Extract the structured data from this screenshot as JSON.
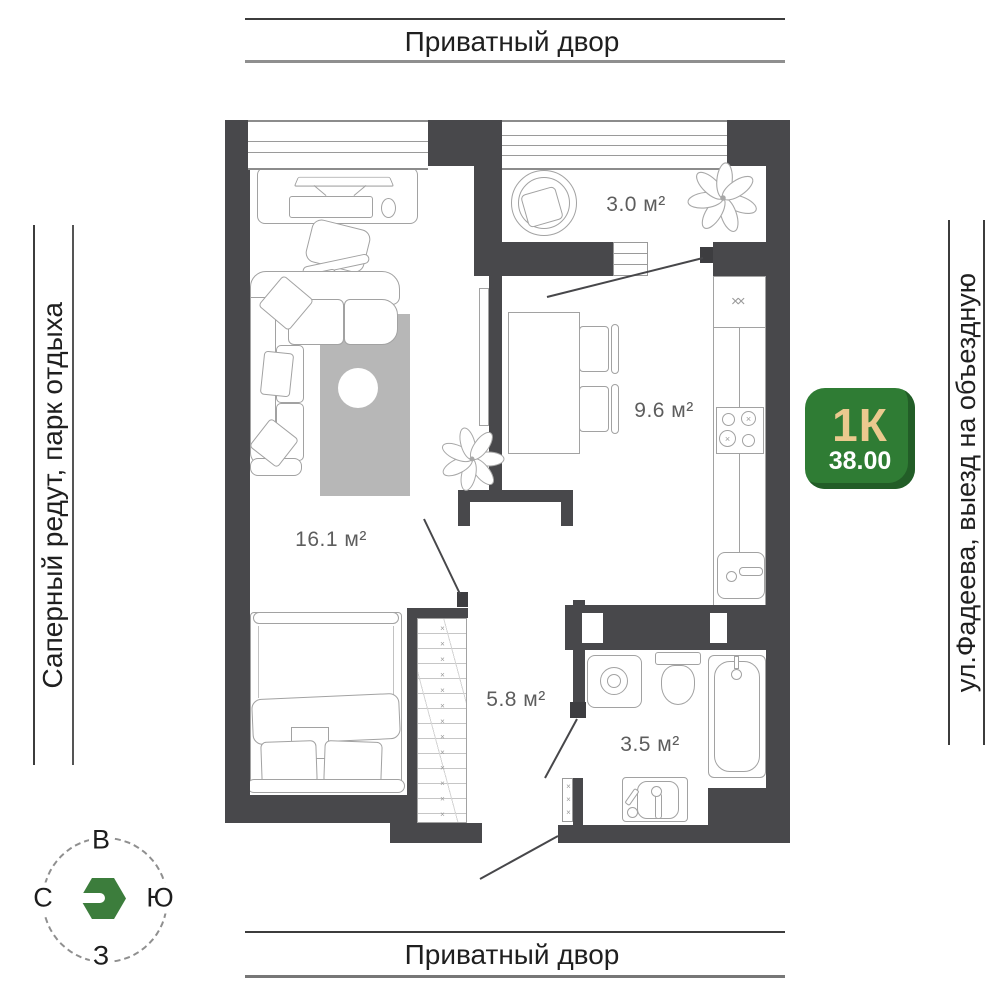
{
  "surround": {
    "top": "Приватный двор",
    "bottom": "Приватный двор",
    "left": "Саперный редут, парк отдыха",
    "right": "ул.Фадеева, выезд на объездную"
  },
  "badge": {
    "rooms": "1К",
    "area": "38.00"
  },
  "rooms": {
    "balcony": "3.0 м²",
    "kitchen": "9.6 м²",
    "living": "16.1 м²",
    "hall": "5.8 м²",
    "bathroom": "3.5 м²"
  },
  "compass": {
    "top": "В",
    "left": "С",
    "right": "Ю",
    "bottom": "З"
  },
  "marks": {
    "wardrobe": "×××××××××××××",
    "shaft": "×××",
    "vent": "××",
    "burner": "×"
  },
  "colors": {
    "wall": "#48484b",
    "badge_green": "#2f7c34",
    "badge_accent": "#ebc98e",
    "furniture_line": "#a2a2a2"
  }
}
